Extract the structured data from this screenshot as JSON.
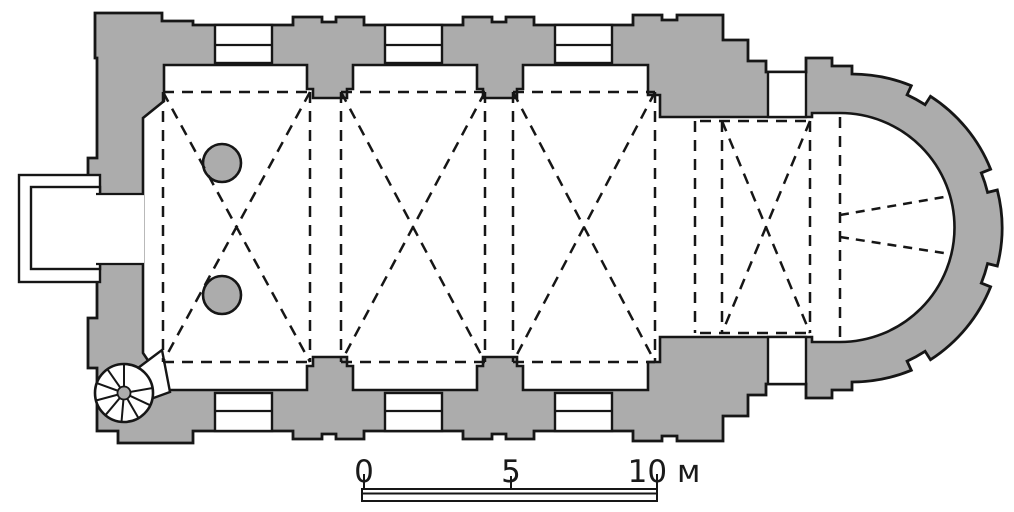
{
  "colors": {
    "wall_gray": "#acacac",
    "line_black": "#161616",
    "background_white": "#ffffff",
    "text_color": "#1a1a1a"
  },
  "scale_bar": {
    "labels": [
      "0",
      "5",
      "10 м"
    ],
    "unit": "м"
  }
}
